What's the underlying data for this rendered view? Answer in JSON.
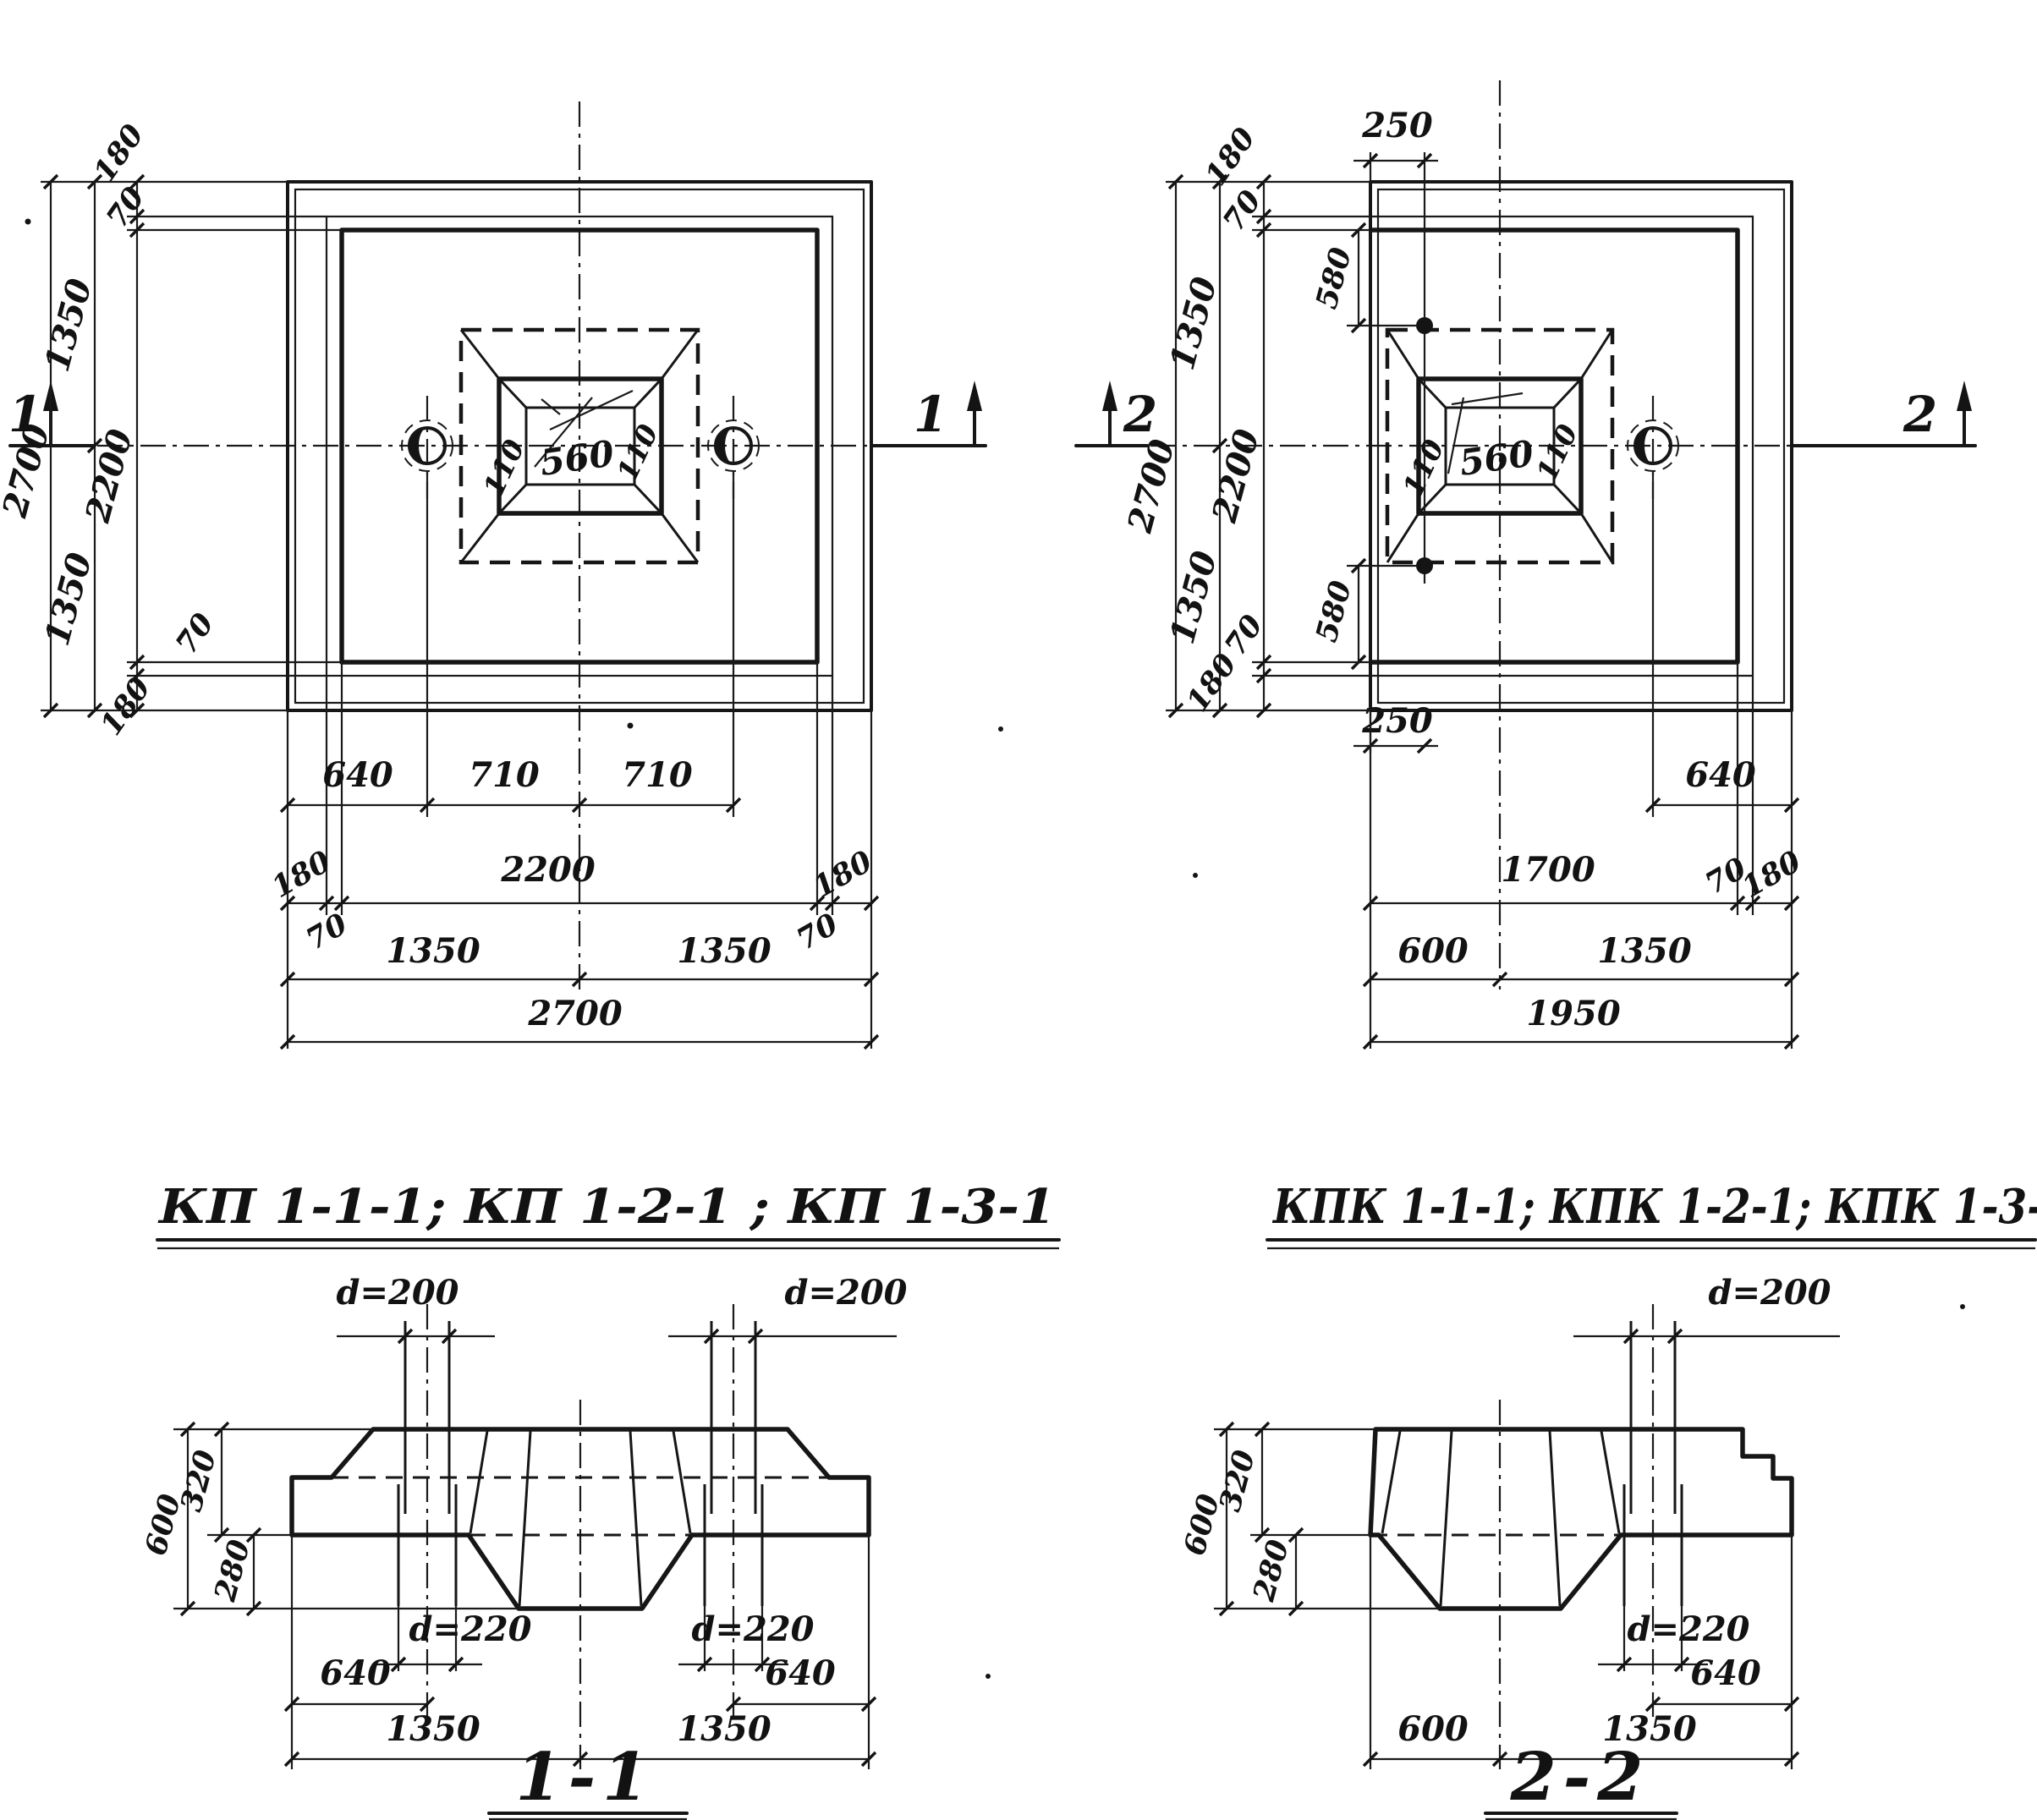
{
  "drawing": {
    "plan_kp": {
      "section_marker": "1",
      "title": "КП 1-1-1; КП 1-2-1 ; КП 1-3-1",
      "glass": {
        "w110_left": "110",
        "w560": "560",
        "w110_right": "110"
      },
      "left_dims": {
        "d2700": "2700",
        "d1350_top": "1350",
        "d1350_bot": "1350",
        "d2200": "2200",
        "d180_top": "180",
        "d70_top": "70",
        "d70_bot": "70",
        "d180_bot": "180"
      },
      "bottom_dims": {
        "d640": "640",
        "d710_left": "710",
        "d710_right": "710",
        "d180_left": "180",
        "d2200": "2200",
        "d180_right": "180",
        "d70_left": "70",
        "d70_right": "70",
        "d1350_left": "1350",
        "d1350_right": "1350",
        "d2700": "2700"
      }
    },
    "plan_kpk": {
      "section_marker": "2",
      "title": "КПК 1-1-1; КПК 1-2-1; КПК 1-3-1",
      "glass": {
        "w110_left": "110",
        "w560": "560",
        "w110_right": "110"
      },
      "top_dims": {
        "d250": "250"
      },
      "left_dims": {
        "d2700": "2700",
        "d1350_top": "1350",
        "d1350_bot": "1350",
        "d2200": "2200",
        "d180_top": "180",
        "d70_top": "70",
        "d580_top": "580",
        "d70_bot": "70",
        "d180_bot": "180",
        "d580_bot": "580",
        "d250_bot": "250"
      },
      "bottom_dims": {
        "d640": "640",
        "d1700": "1700",
        "d70": "70",
        "d180": "180",
        "d600": "600",
        "d1350": "1350",
        "d1950": "1950"
      }
    },
    "section_1_1": {
      "title": "1-1",
      "dims": {
        "d200_left": "d=200",
        "d200_right": "d=200",
        "d220_left": "d=220",
        "d220_right": "d=220",
        "v600": "600",
        "v320": "320",
        "v280": "280",
        "b640_left": "640",
        "b640_right": "640",
        "b1350_left": "1350",
        "b1350_right": "1350"
      }
    },
    "section_2_2": {
      "title": "2-2",
      "dims": {
        "d200": "d=200",
        "d220": "d=220",
        "v600": "600",
        "v320": "320",
        "v280": "280",
        "b640": "640",
        "b600": "600",
        "b1350": "1350"
      }
    }
  }
}
